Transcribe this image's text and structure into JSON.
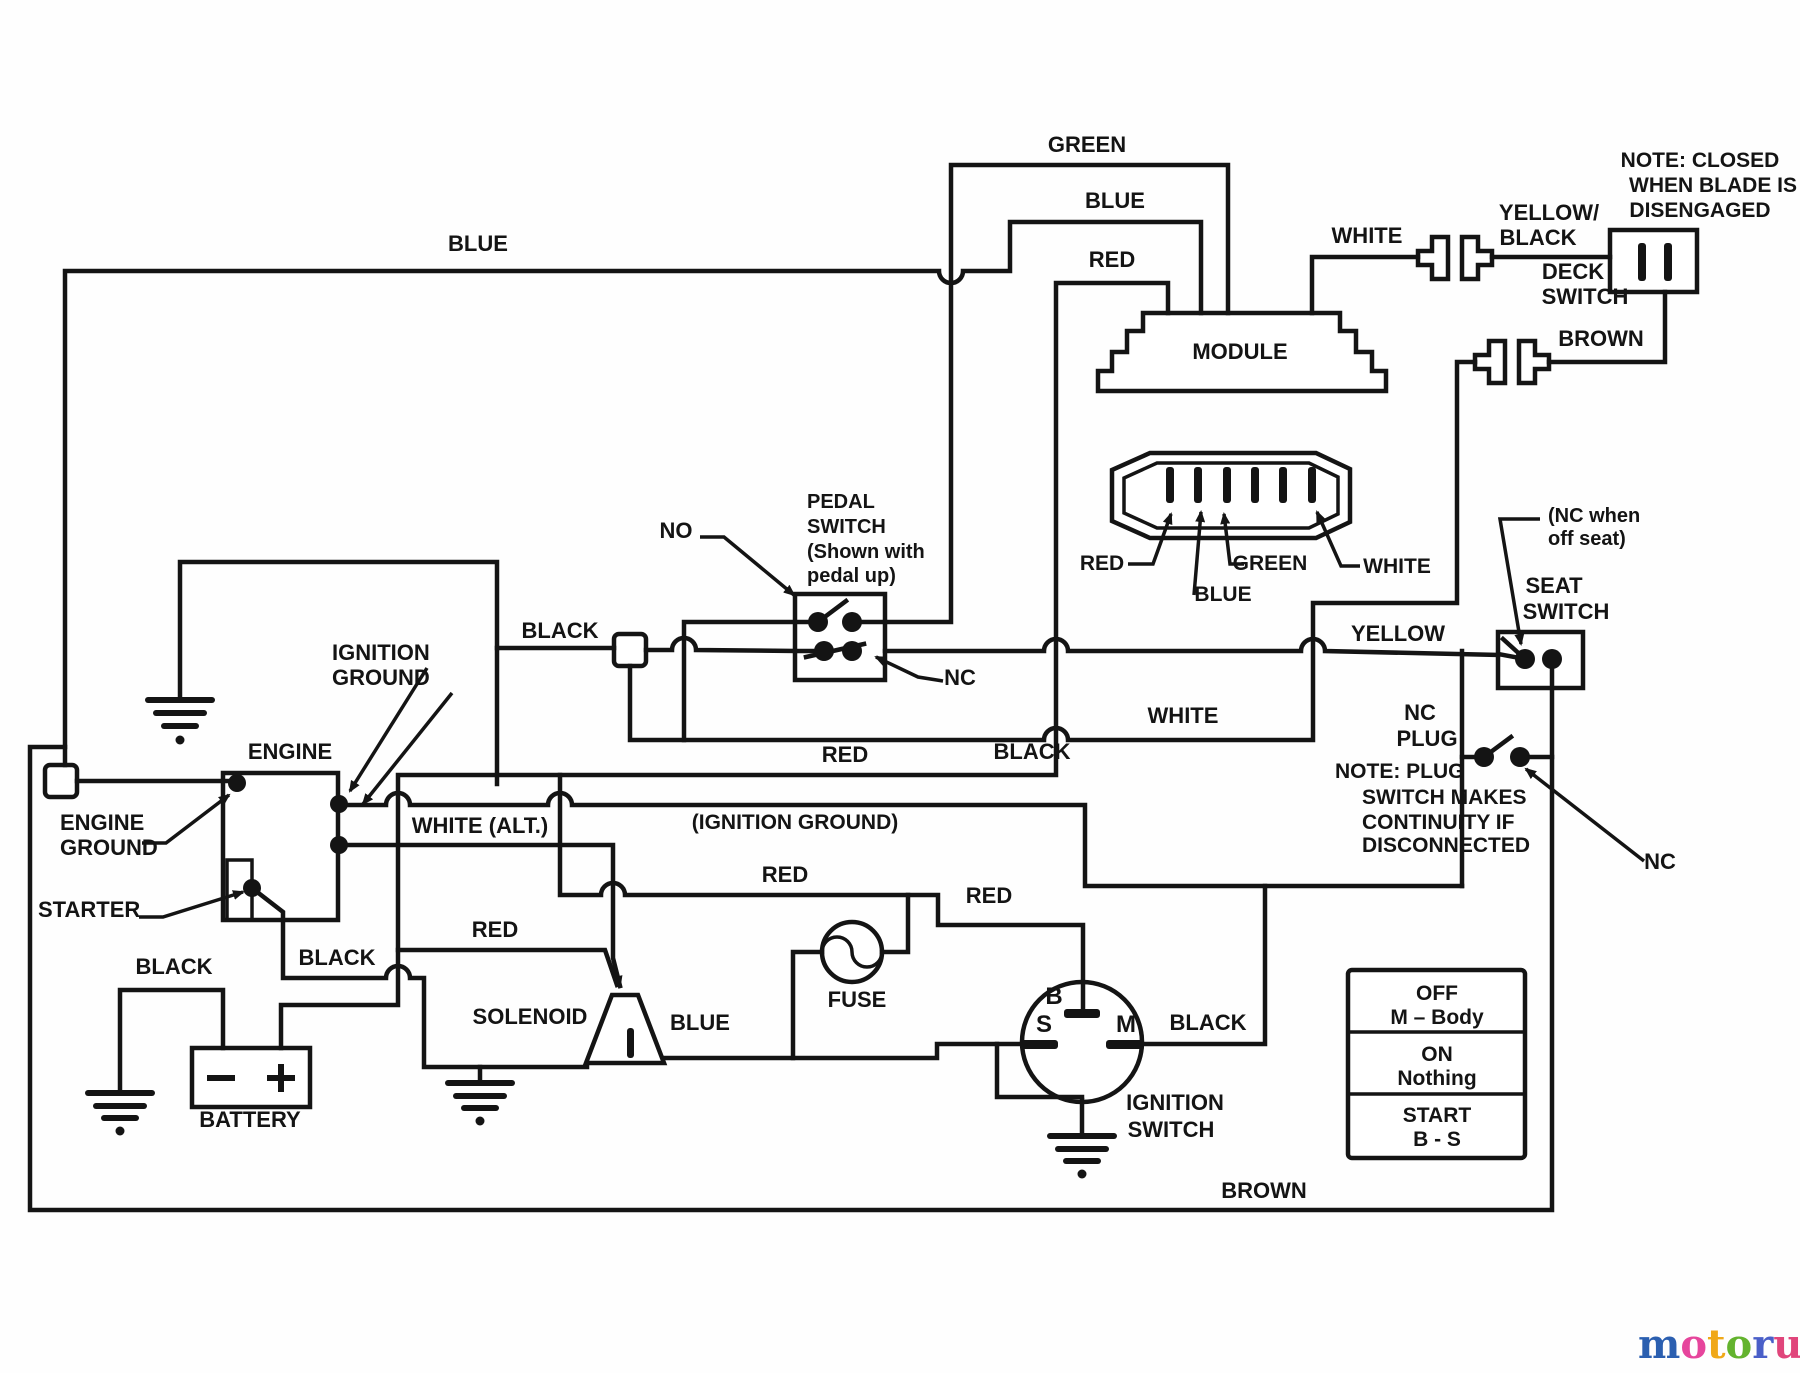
{
  "labels": [
    {
      "name": "wire-label-green-top",
      "text": "GREEN",
      "x": 1087,
      "y": 152
    },
    {
      "name": "wire-label-blue-top",
      "text": "BLUE",
      "x": 1115,
      "y": 208
    },
    {
      "name": "wire-label-red-top",
      "text": "RED",
      "x": 1112,
      "y": 267
    },
    {
      "name": "wire-label-blue-left",
      "text": "BLUE",
      "x": 478,
      "y": 251
    },
    {
      "name": "wire-label-white-top",
      "text": "WHITE",
      "x": 1367,
      "y": 243
    },
    {
      "name": "wire-label-yellow-black-1",
      "text": "YELLOW/",
      "x": 1549,
      "y": 220
    },
    {
      "name": "wire-label-yellow-black-2",
      "text": "BLACK",
      "x": 1538,
      "y": 245
    },
    {
      "name": "deck-switch-label-1",
      "text": "DECK",
      "x": 1573,
      "y": 279
    },
    {
      "name": "deck-switch-label-2",
      "text": "SWITCH",
      "x": 1585,
      "y": 304
    },
    {
      "name": "wire-label-brown-top",
      "text": "BROWN",
      "x": 1601,
      "y": 346
    },
    {
      "name": "note-blade-line-1",
      "text": "NOTE:  CLOSED",
      "x": 1700,
      "y": 167,
      "fs": 21
    },
    {
      "name": "note-blade-line-2",
      "text": "WHEN BLADE IS",
      "x": 1713,
      "y": 192,
      "fs": 21
    },
    {
      "name": "note-blade-line-3",
      "text": "DISENGAGED",
      "x": 1700,
      "y": 217,
      "fs": 21
    },
    {
      "name": "module-label",
      "text": "MODULE",
      "x": 1240,
      "y": 359
    },
    {
      "name": "pin-label-red",
      "text": "RED",
      "x": 1102,
      "y": 570,
      "fs": 21
    },
    {
      "name": "pin-label-green",
      "text": "GREEN",
      "x": 1270,
      "y": 570,
      "fs": 21
    },
    {
      "name": "pin-label-blue",
      "text": "BLUE",
      "x": 1223,
      "y": 601,
      "fs": 21
    },
    {
      "name": "pin-label-white",
      "text": "WHITE",
      "x": 1397,
      "y": 573,
      "fs": 21
    },
    {
      "name": "pedal-switch-label-1",
      "text": "PEDAL",
      "x": 807,
      "y": 508,
      "anchor": "start",
      "fs": 20
    },
    {
      "name": "pedal-switch-label-2",
      "text": "SWITCH",
      "x": 807,
      "y": 533,
      "anchor": "start",
      "fs": 20
    },
    {
      "name": "pedal-switch-label-3",
      "text": "(Shown with",
      "x": 807,
      "y": 558,
      "anchor": "start",
      "fs": 20
    },
    {
      "name": "pedal-switch-label-4",
      "text": "pedal up)",
      "x": 807,
      "y": 582,
      "anchor": "start",
      "fs": 20
    },
    {
      "name": "no-contact-label",
      "text": "NO",
      "x": 676,
      "y": 538
    },
    {
      "name": "nc-pedal-label",
      "text": "NC",
      "x": 960,
      "y": 685
    },
    {
      "name": "wire-label-black-mid",
      "text": "BLACK",
      "x": 560,
      "y": 638
    },
    {
      "name": "seat-note-line-1",
      "text": "(NC when",
      "x": 1548,
      "y": 522,
      "anchor": "start",
      "fs": 20
    },
    {
      "name": "seat-note-line-2",
      "text": "off seat)",
      "x": 1548,
      "y": 545,
      "anchor": "start",
      "fs": 20
    },
    {
      "name": "seat-switch-label-1",
      "text": "SEAT",
      "x": 1554,
      "y": 593
    },
    {
      "name": "seat-switch-label-2",
      "text": "SWITCH",
      "x": 1566,
      "y": 619
    },
    {
      "name": "wire-label-yellow",
      "text": "YELLOW",
      "x": 1398,
      "y": 641
    },
    {
      "name": "nc-plug-label-1",
      "text": "NC",
      "x": 1420,
      "y": 720
    },
    {
      "name": "nc-plug-label-2",
      "text": "PLUG",
      "x": 1427,
      "y": 746
    },
    {
      "name": "wire-label-white-mid",
      "text": "WHITE",
      "x": 1183,
      "y": 723
    },
    {
      "name": "wire-label-red-mid",
      "text": "RED",
      "x": 845,
      "y": 762
    },
    {
      "name": "note-plug-line-1",
      "text": "NOTE:  PLUG",
      "x": 1335,
      "y": 778,
      "anchor": "start",
      "fs": 21
    },
    {
      "name": "note-plug-line-2",
      "text": "SWITCH MAKES",
      "x": 1362,
      "y": 804,
      "anchor": "start",
      "fs": 21
    },
    {
      "name": "note-plug-line-3",
      "text": "CONTINUITY IF",
      "x": 1362,
      "y": 829,
      "anchor": "start",
      "fs": 21
    },
    {
      "name": "note-plug-line-4",
      "text": "DISCONNECTED",
      "x": 1362,
      "y": 852,
      "anchor": "start",
      "fs": 21
    },
    {
      "name": "nc-far-label",
      "text": "NC",
      "x": 1660,
      "y": 869
    },
    {
      "name": "ignition-ground-label-1",
      "text": "IGNITION",
      "x": 332,
      "y": 660,
      "anchor": "start"
    },
    {
      "name": "ignition-ground-label-2",
      "text": "GROUND",
      "x": 332,
      "y": 685,
      "anchor": "start"
    },
    {
      "name": "engine-label",
      "text": "ENGINE",
      "x": 290,
      "y": 759
    },
    {
      "name": "engine-ground-label-1",
      "text": "ENGINE",
      "x": 60,
      "y": 830,
      "anchor": "start"
    },
    {
      "name": "engine-ground-label-2",
      "text": "GROUND",
      "x": 60,
      "y": 855,
      "anchor": "start"
    },
    {
      "name": "starter-label",
      "text": "STARTER",
      "x": 38,
      "y": 917,
      "anchor": "start"
    },
    {
      "name": "ignition-ground-paren-label",
      "text": "(IGNITION GROUND)",
      "x": 795,
      "y": 829,
      "fs": 21
    },
    {
      "name": "wire-label-white-alt",
      "text": "WHITE (ALT.)",
      "x": 480,
      "y": 833
    },
    {
      "name": "wire-label-black-upper",
      "text": "BLACK",
      "x": 1032,
      "y": 759
    },
    {
      "name": "wire-label-black-starter",
      "text": "BLACK",
      "x": 337,
      "y": 965
    },
    {
      "name": "wire-label-black-battery",
      "text": "BLACK",
      "x": 174,
      "y": 974
    },
    {
      "name": "wire-label-red-fuse",
      "text": "RED",
      "x": 785,
      "y": 882
    },
    {
      "name": "wire-label-red-b",
      "text": "RED",
      "x": 989,
      "y": 903
    },
    {
      "name": "fuse-label",
      "text": "FUSE",
      "x": 857,
      "y": 1007
    },
    {
      "name": "wire-label-red-solenoid",
      "text": "RED",
      "x": 495,
      "y": 937
    },
    {
      "name": "solenoid-label",
      "text": "SOLENOID",
      "x": 530,
      "y": 1024
    },
    {
      "name": "terminal-b-label",
      "text": "B",
      "x": 1054,
      "y": 1004,
      "fs": 24
    },
    {
      "name": "terminal-s-label",
      "text": "S",
      "x": 1044,
      "y": 1032,
      "fs": 24
    },
    {
      "name": "terminal-m-label",
      "text": "M",
      "x": 1126,
      "y": 1032,
      "fs": 24
    },
    {
      "name": "wire-label-black-m",
      "text": "BLACK",
      "x": 1208,
      "y": 1030
    },
    {
      "name": "ignition-switch-label-1",
      "text": "IGNITION",
      "x": 1175,
      "y": 1110
    },
    {
      "name": "ignition-switch-label-2",
      "text": "SWITCH",
      "x": 1171,
      "y": 1137
    },
    {
      "name": "battery-label",
      "text": "BATTERY",
      "x": 250,
      "y": 1127
    },
    {
      "name": "wire-label-blue-bottom",
      "text": "BLUE",
      "x": 700,
      "y": 1030
    },
    {
      "name": "wire-label-brown-bottom",
      "text": "BROWN",
      "x": 1264,
      "y": 1198
    }
  ],
  "table": {
    "rows": [
      {
        "position": "OFF",
        "contacts": "M – Body"
      },
      {
        "position": "ON",
        "contacts": "Nothing"
      },
      {
        "position": "START",
        "contacts": "B - S"
      }
    ]
  },
  "logo": {
    "letters": [
      {
        "ch": "m",
        "color": "#2b5fb0"
      },
      {
        "ch": "o",
        "color": "#e6459c"
      },
      {
        "ch": "t",
        "color": "#f0a818"
      },
      {
        "ch": "o",
        "color": "#63b32e"
      },
      {
        "ch": "r",
        "color": "#4a5fc8"
      },
      {
        "ch": "u",
        "color": "#e0457b"
      },
      {
        "ch": "f",
        "color": "#f08818"
      }
    ],
    "suffix": ".de",
    "suffix_color": "#555555"
  }
}
